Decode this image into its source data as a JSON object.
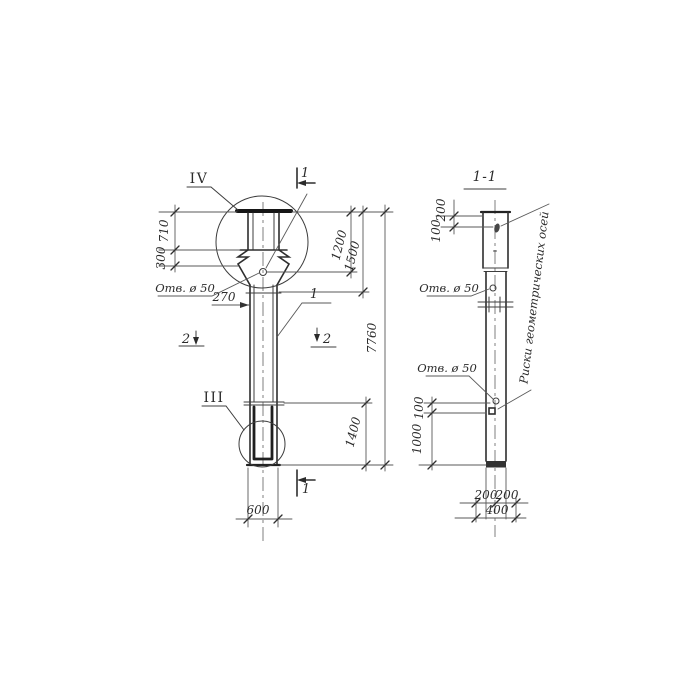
{
  "left_view": {
    "detail_top": "IV",
    "detail_bottom": "III",
    "cut_top": "1",
    "cut_bottom": "1",
    "cut_left": "2",
    "cut_right": "2",
    "callout": "1",
    "hole_label": "Отв. ø 50",
    "dims": {
      "cap": "710",
      "collar": "300",
      "neck": "270",
      "to_hole": "1200",
      "to_neck": "1500",
      "total": "7760",
      "tip": "1400",
      "width": "600"
    }
  },
  "section_view": {
    "title": "1-1",
    "hole_label_upper": "Отв. ø 50",
    "hole_label_lower": "Отв. ø 50",
    "axes_label": "Риски геометрических осей",
    "dims": {
      "top": "200",
      "top_hole": "100",
      "mark": "100",
      "lower": "1000",
      "bottom_left": "200",
      "bottom_right": "200",
      "bottom_total": "400"
    }
  }
}
